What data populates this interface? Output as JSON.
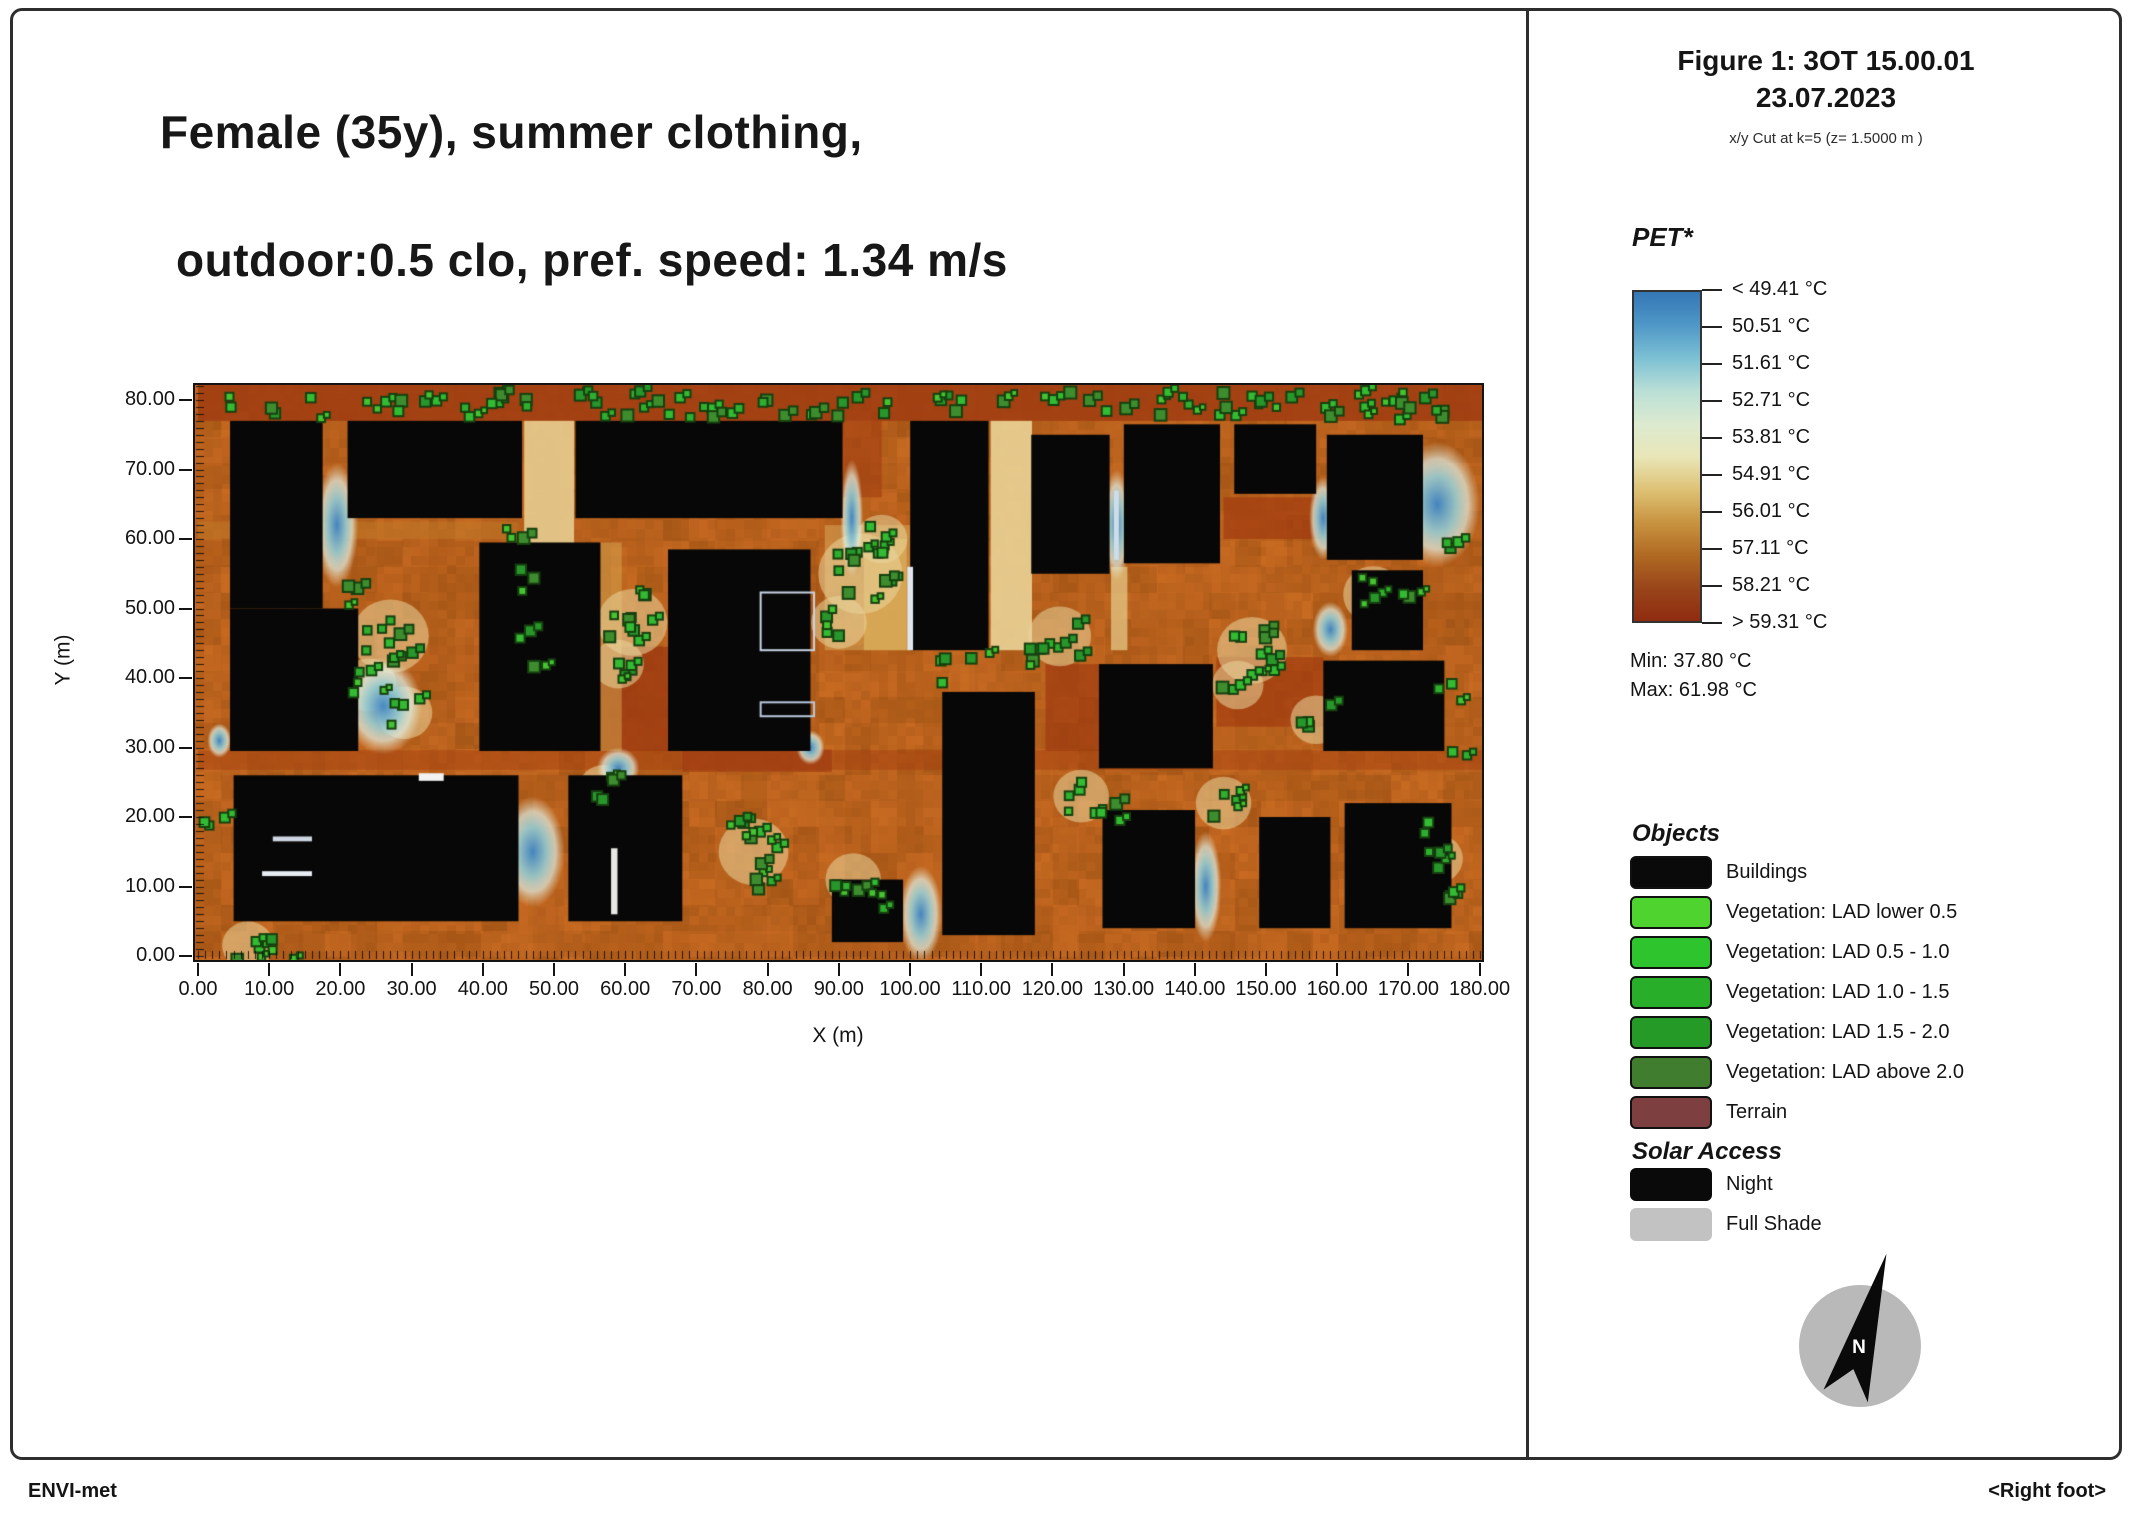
{
  "header": {
    "line1": "Female (35y), summer clothing,",
    "line2": "outdoor:0.5 clo, pref. speed: 1.34 m/s"
  },
  "figure_info": {
    "title": "Figure 1: 3OT 15.00.01",
    "date": "23.07.2023",
    "cut": "x/y Cut at k=5 (z= 1.5000 m )"
  },
  "footer": {
    "left": "ENVI-met",
    "right": "<Right foot>"
  },
  "compass": {
    "label": "N"
  },
  "chart_data": {
    "type": "heatmap",
    "title": "PET heatmap, x/y cut at z=1.5 m",
    "xlabel": "X (m)",
    "ylabel": "Y (m)",
    "x_ticks": [
      "0.00",
      "10.00",
      "20.00",
      "30.00",
      "40.00",
      "50.00",
      "60.00",
      "70.00",
      "80.00",
      "90.00",
      "100.00",
      "110.00",
      "120.00",
      "130.00",
      "140.00",
      "150.00",
      "160.00",
      "170.00",
      "180.00"
    ],
    "y_ticks": [
      "80.00",
      "70.00",
      "60.00",
      "50.00",
      "40.00",
      "30.00",
      "20.00",
      "10.00",
      "0.00"
    ],
    "x_range_m": [
      0,
      180
    ],
    "y_range_m": [
      0,
      80
    ],
    "grid": false,
    "colorbar": {
      "title": "PET*",
      "tick_labels": [
        "< 49.41 °C",
        "50.51  °C",
        "51.61  °C",
        "52.71  °C",
        "53.81  °C",
        "54.91  °C",
        "56.01  °C",
        "57.11  °C",
        "58.21  °C",
        "> 59.31 °C"
      ],
      "min_label": "Min: 37.80 °C",
      "max_label": "Max: 61.98 °C",
      "gradient": [
        "#3377b5",
        "#4f97c7",
        "#7cc0d4",
        "#b9dfd6",
        "#dcead0",
        "#e9e6b8",
        "#dec276",
        "#c89440",
        "#b06a22",
        "#99451a",
        "#8f2c10"
      ]
    },
    "objects_legend": {
      "title": "Objects",
      "items": [
        {
          "label": "Buildings",
          "color": "#0a0a0a",
          "border": true
        },
        {
          "label": "Vegetation: LAD lower 0.5",
          "color": "#4fd32f",
          "border": true
        },
        {
          "label": "Vegetation:  LAD 0.5 - 1.0",
          "color": "#2ec42e",
          "border": true
        },
        {
          "label": "Vegetation:  LAD 1.0 - 1.5",
          "color": "#29ae29",
          "border": true
        },
        {
          "label": "Vegetation:  LAD 1.5 - 2.0",
          "color": "#269a26",
          "border": true
        },
        {
          "label": "Vegetation:  LAD above 2.0",
          "color": "#417d2f",
          "border": true
        },
        {
          "label": "Terrain",
          "color": "#7d3f3f",
          "border": true
        }
      ]
    },
    "solar_legend": {
      "title": "Solar Access",
      "items": [
        {
          "label": "Night",
          "color": "#0a0a0a",
          "border": false
        },
        {
          "label": "Full Shade",
          "color": "#c2c2c2",
          "border": false
        }
      ]
    },
    "map": {
      "ground_base": "#b2641e",
      "buildings": [
        {
          "x": 4.5,
          "y": 50,
          "w": 13,
          "h": 27
        },
        {
          "x": 4.5,
          "y": 29.5,
          "w": 18,
          "h": 20.5
        },
        {
          "x": 21,
          "y": 63,
          "w": 24.5,
          "h": 14
        },
        {
          "x": 53,
          "y": 63,
          "w": 37.5,
          "h": 14
        },
        {
          "x": 100,
          "y": 44,
          "w": 11,
          "h": 33
        },
        {
          "x": 117,
          "y": 55,
          "w": 11,
          "h": 20
        },
        {
          "x": 130,
          "y": 56.5,
          "w": 13.5,
          "h": 20
        },
        {
          "x": 145.5,
          "y": 66.5,
          "w": 11.5,
          "h": 10
        },
        {
          "x": 158.5,
          "y": 57,
          "w": 13.5,
          "h": 18
        },
        {
          "x": 39.5,
          "y": 29.5,
          "w": 17,
          "h": 30
        },
        {
          "x": 66,
          "y": 29.5,
          "w": 20,
          "h": 29
        },
        {
          "x": 126.5,
          "y": 27,
          "w": 16,
          "h": 15
        },
        {
          "x": 158,
          "y": 29.5,
          "w": 17,
          "h": 13
        },
        {
          "x": 162,
          "y": 44,
          "w": 10,
          "h": 11.5
        },
        {
          "x": 5,
          "y": 5,
          "w": 40,
          "h": 21
        },
        {
          "x": 52,
          "y": 5,
          "w": 16,
          "h": 21
        },
        {
          "x": 89,
          "y": 2,
          "w": 10,
          "h": 9
        },
        {
          "x": 104.5,
          "y": 3,
          "w": 13,
          "h": 35
        },
        {
          "x": 127,
          "y": 4,
          "w": 13,
          "h": 17
        },
        {
          "x": 149,
          "y": 4,
          "w": 10,
          "h": 16
        },
        {
          "x": 161,
          "y": 4,
          "w": 15,
          "h": 18
        }
      ],
      "ground_patches": [
        [
          0,
          77,
          181,
          6,
          "#a03c12",
          0.85
        ],
        [
          0,
          26.8,
          181,
          2.8,
          "#a5400f",
          0.5
        ],
        [
          56,
          29.5,
          10,
          15,
          "#9e3a10",
          0.8
        ],
        [
          119,
          29.5,
          7.5,
          12.5,
          "#9e3a10",
          0.7
        ],
        [
          143,
          33,
          15,
          10,
          "#a23c10",
          0.7
        ],
        [
          86,
          66,
          10,
          11,
          "#a23c10",
          0.6
        ],
        [
          144,
          60,
          14,
          6,
          "#a23c10",
          0.7
        ],
        [
          68,
          26.5,
          21,
          3.2,
          "#a03c12",
          0.7
        ],
        [
          45.8,
          55,
          7,
          22,
          "#e7cd90",
          0.9
        ],
        [
          111.3,
          44,
          5.8,
          33,
          "#ead397",
          0.9
        ],
        [
          93.5,
          44,
          6,
          16,
          "#d9a955",
          0.85
        ],
        [
          128.2,
          44,
          2.3,
          12,
          "#e2c280",
          0.8
        ],
        [
          56.5,
          29.5,
          3,
          30,
          "#d7a851",
          0.5
        ],
        [
          88,
          44,
          12,
          18,
          "#d9ae5e",
          0.5
        ],
        [
          0,
          60,
          45,
          2.5,
          "#c07a28",
          0.5
        ]
      ],
      "cool_spots": [
        [
          19.5,
          62,
          3,
          9
        ],
        [
          26,
          36,
          5.5,
          7
        ],
        [
          47,
          15,
          4.5,
          8
        ],
        [
          59,
          27,
          3,
          3
        ],
        [
          91.8,
          63,
          1.6,
          8.5
        ],
        [
          129,
          62,
          2,
          8
        ],
        [
          174,
          65,
          6,
          9
        ],
        [
          158,
          63,
          2,
          6
        ],
        [
          159,
          47,
          2.5,
          4
        ],
        [
          141.5,
          10,
          2.2,
          8
        ],
        [
          101.5,
          6,
          3,
          7
        ],
        [
          3,
          31,
          1.7,
          2.5
        ],
        [
          86,
          30,
          2,
          2.5
        ]
      ],
      "vegetation_clusters": [
        [
          6,
          79,
          2,
          1.6
        ],
        [
          11,
          79.3,
          2,
          1.6
        ],
        [
          16,
          78.8,
          2,
          1.6
        ],
        [
          25,
          79.4,
          3,
          1.8
        ],
        [
          29,
          78.8,
          2,
          1.6
        ],
        [
          33,
          79.7,
          3,
          1.8
        ],
        [
          38,
          79,
          3,
          1.8
        ],
        [
          42,
          79.5,
          4,
          2
        ],
        [
          47,
          78.8,
          2,
          1.6
        ],
        [
          53,
          79.3,
          2,
          1.6
        ],
        [
          57,
          79,
          3,
          1.8
        ],
        [
          61,
          79.7,
          4,
          2
        ],
        [
          66,
          79,
          3,
          1.8
        ],
        [
          71,
          79.4,
          4,
          2
        ],
        [
          76,
          78.8,
          2,
          1.6
        ],
        [
          81,
          79.5,
          3,
          1.8
        ],
        [
          86,
          79,
          2,
          1.6
        ],
        [
          91,
          79.5,
          3,
          1.8
        ],
        [
          97,
          78.9,
          2,
          1.6
        ],
        [
          103,
          79.4,
          2,
          1.6
        ],
        [
          108,
          78.8,
          2,
          1.6
        ],
        [
          113,
          79.4,
          2,
          1.6
        ],
        [
          119,
          79.1,
          2,
          1.6
        ],
        [
          124,
          79.5,
          2,
          1.6
        ],
        [
          129,
          79,
          2,
          1.6
        ],
        [
          135,
          79.5,
          3,
          1.8
        ],
        [
          140,
          78.9,
          3,
          1.8
        ],
        [
          145,
          79.6,
          4,
          2
        ],
        [
          148,
          78.8,
          3,
          1.8
        ],
        [
          153,
          79.3,
          2,
          1.6
        ],
        [
          158,
          79,
          2,
          1.6
        ],
        [
          163,
          79.7,
          4,
          2
        ],
        [
          167,
          78.9,
          3,
          1.8
        ],
        [
          171,
          79.4,
          4,
          2
        ],
        [
          175,
          78.8,
          3,
          1.8
        ],
        [
          27,
          46,
          9,
          4
        ],
        [
          24,
          39,
          5,
          2.5
        ],
        [
          29,
          35,
          4,
          2.5
        ],
        [
          21,
          52,
          3,
          1.8
        ],
        [
          45,
          60,
          3,
          1.8
        ],
        [
          47,
          54,
          3,
          1.8
        ],
        [
          46,
          47,
          2,
          1.5
        ],
        [
          48,
          41,
          2,
          1.5
        ],
        [
          61,
          48,
          8,
          3.5
        ],
        [
          59,
          42,
          4,
          2.2
        ],
        [
          63,
          53,
          3,
          1.8
        ],
        [
          93,
          55,
          11,
          4.5
        ],
        [
          90,
          48,
          5,
          2.5
        ],
        [
          96,
          60,
          4,
          2.2
        ],
        [
          106,
          41,
          3,
          1.8
        ],
        [
          110,
          44,
          2,
          1.5
        ],
        [
          121,
          46,
          7,
          3
        ],
        [
          118,
          43,
          3,
          1.8
        ],
        [
          148,
          44,
          8,
          3.5
        ],
        [
          146,
          39,
          4,
          2.2
        ],
        [
          157,
          34,
          4,
          2.2
        ],
        [
          165,
          52,
          5,
          2.8
        ],
        [
          171,
          53,
          3,
          1.8
        ],
        [
          176,
          59,
          3,
          1.8
        ],
        [
          176,
          38,
          3,
          1.8
        ],
        [
          177,
          30,
          2,
          1.4
        ],
        [
          78,
          15,
          8,
          3.5
        ],
        [
          75,
          20,
          3,
          1.8
        ],
        [
          80,
          10,
          3,
          1.8
        ],
        [
          57,
          24,
          4,
          2.2
        ],
        [
          92,
          11,
          5,
          2.5
        ],
        [
          96,
          8,
          3,
          1.8
        ],
        [
          124,
          23,
          5,
          2.5
        ],
        [
          128,
          21,
          3,
          1.8
        ],
        [
          144,
          22,
          5,
          2.5
        ],
        [
          174,
          14,
          4,
          2.2
        ],
        [
          175,
          9,
          3,
          1.8
        ],
        [
          173,
          19,
          2,
          1.4
        ],
        [
          2,
          19,
          3,
          1.8
        ],
        [
          7,
          1.5,
          4,
          2.2
        ],
        [
          12,
          1,
          3,
          1.8
        ]
      ],
      "outline_markers": [
        {
          "x": 79,
          "y": 44,
          "w": 7.5,
          "h": 8.3,
          "mode": "stroke",
          "color": "#c8d4e4"
        },
        {
          "x": 79,
          "y": 34.5,
          "w": 7.5,
          "h": 2,
          "mode": "stroke",
          "color": "#b9c8dc"
        },
        {
          "x": 10.5,
          "y": 16.5,
          "w": 5.5,
          "h": 0.7,
          "mode": "fill",
          "color": "#cdd6e2"
        },
        {
          "x": 9,
          "y": 11.5,
          "w": 7,
          "h": 0.7,
          "mode": "fill",
          "color": "#e8eef4"
        },
        {
          "x": 31,
          "y": 25.2,
          "w": 3.5,
          "h": 1.1,
          "mode": "fill",
          "color": "#f2f2f0"
        },
        {
          "x": 58,
          "y": 6,
          "w": 0.9,
          "h": 9.5,
          "mode": "fill",
          "color": "#e8e8e4"
        },
        {
          "x": 99.6,
          "y": 44,
          "w": 0.8,
          "h": 12,
          "mode": "fill",
          "color": "#dfe6ee"
        },
        {
          "x": 128.6,
          "y": 57,
          "w": 0.7,
          "h": 10,
          "mode": "fill",
          "color": "#cfdcea"
        }
      ]
    }
  }
}
